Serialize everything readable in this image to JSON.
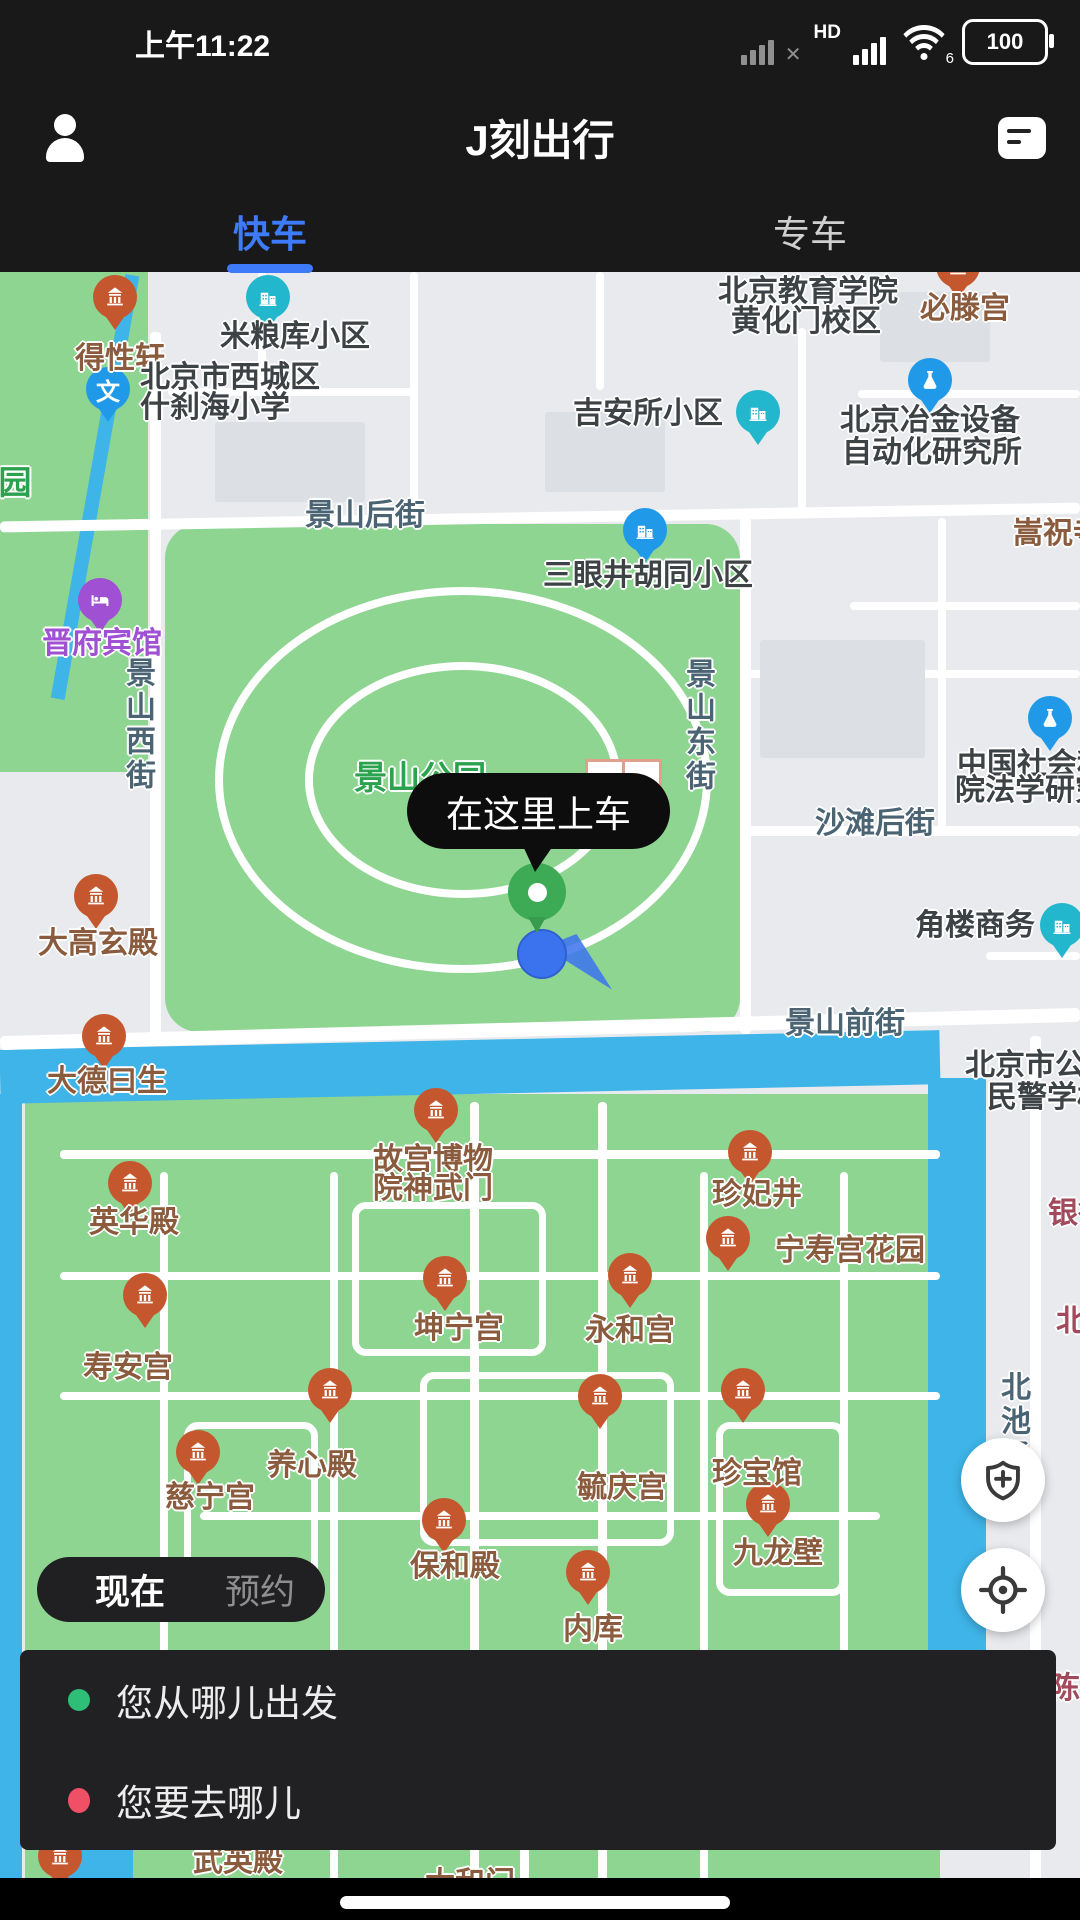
{
  "status_bar": {
    "time": "上午11:22",
    "hd_label": "HD",
    "wifi_label": "6",
    "battery_percent": "100"
  },
  "header": {
    "title": "J刻出行"
  },
  "tabs": [
    {
      "label": "快车",
      "active": true
    },
    {
      "label": "专车",
      "active": false
    }
  ],
  "colors": {
    "accent_blue": "#3e7bfa",
    "park_green": "#8fd592",
    "water_blue": "#3fb4e8",
    "temple_pin": "#c5572f",
    "teal_pin": "#23b7cd",
    "blue_pin": "#209ae8",
    "hotel_pin": "#a050d2",
    "pickup_green": "#3dab55",
    "location_blue": "#3b72ee",
    "from_dot": "#2fbe78",
    "to_dot": "#ef5066"
  },
  "map": {
    "pickup_bubble": "在这里上车",
    "labels": [
      {
        "t": "景山后街",
        "x": 365,
        "y": 240,
        "k": "street"
      },
      {
        "t": "景山西街",
        "x": 137,
        "y": 453,
        "k": "street",
        "v": 1
      },
      {
        "t": "景山东街",
        "x": 697,
        "y": 454,
        "k": "street",
        "v": 1
      },
      {
        "t": "沙滩后街",
        "x": 875,
        "y": 548,
        "k": "street"
      },
      {
        "t": "景山前街",
        "x": 845,
        "y": 748,
        "k": "street"
      },
      {
        "t": "北池子",
        "x": 1012,
        "y": 1150,
        "k": "street",
        "v": 1
      },
      {
        "t": "园",
        "x": 15,
        "y": 208,
        "k": "green"
      },
      {
        "t": "景山公园",
        "x": 420,
        "y": 503,
        "k": "green"
      },
      {
        "t": "银行",
        "x": 1048,
        "y": 938,
        "k": "maroon",
        "a": "l"
      },
      {
        "t": "北新",
        "x": 1056,
        "y": 1046,
        "k": "maroon",
        "a": "l"
      },
      {
        "t": "陈列",
        "x": 1050,
        "y": 1413,
        "k": "maroon",
        "a": "l"
      },
      {
        "t": "得性轩",
        "x": 120,
        "y": 83,
        "k": "brown"
      },
      {
        "t": "必滕宫",
        "x": 965,
        "y": 33,
        "k": "brown"
      },
      {
        "t": "嵩祝寺",
        "x": 1013,
        "y": 258,
        "k": "brown",
        "a": "l"
      },
      {
        "t": "晋府宾馆",
        "x": 102,
        "y": 368,
        "k": "purple"
      },
      {
        "t": "大高玄殿",
        "x": 98,
        "y": 668,
        "k": "brown"
      },
      {
        "t": "大德曰生",
        "x": 107,
        "y": 806,
        "k": "brown"
      },
      {
        "t": "故宫博物",
        "x": 433,
        "y": 884,
        "k": "brown"
      },
      {
        "t": "院神武门",
        "x": 433,
        "y": 913,
        "k": "brown"
      },
      {
        "t": "珍妃井",
        "x": 757,
        "y": 919,
        "k": "brown"
      },
      {
        "t": "宁寿宫花园",
        "x": 850,
        "y": 975,
        "k": "brown"
      },
      {
        "t": "英华殿",
        "x": 134,
        "y": 947,
        "k": "brown"
      },
      {
        "t": "寿安宫",
        "x": 128,
        "y": 1092,
        "k": "brown"
      },
      {
        "t": "坤宁宫",
        "x": 459,
        "y": 1053,
        "k": "brown"
      },
      {
        "t": "永和宫",
        "x": 630,
        "y": 1055,
        "k": "brown"
      },
      {
        "t": "养心殿",
        "x": 312,
        "y": 1190,
        "k": "brown"
      },
      {
        "t": "毓庆宫",
        "x": 622,
        "y": 1212,
        "k": "brown"
      },
      {
        "t": "珍宝馆",
        "x": 757,
        "y": 1198,
        "k": "brown"
      },
      {
        "t": "慈宁宫",
        "x": 210,
        "y": 1222,
        "k": "brown"
      },
      {
        "t": "保和殿",
        "x": 455,
        "y": 1291,
        "k": "brown"
      },
      {
        "t": "九龙壁",
        "x": 778,
        "y": 1278,
        "k": "brown"
      },
      {
        "t": "内库",
        "x": 593,
        "y": 1354,
        "k": "brown"
      },
      {
        "t": "武英殿",
        "x": 238,
        "y": 1586,
        "k": "brown"
      },
      {
        "t": "太和门",
        "x": 470,
        "y": 1608,
        "k": "brown"
      },
      {
        "t": "米粮库小区",
        "x": 295,
        "y": 61,
        "k": "dark"
      },
      {
        "t": "北京市西城区",
        "x": 140,
        "y": 102,
        "k": "dark",
        "a": "l"
      },
      {
        "t": "什刹海小学",
        "x": 140,
        "y": 132,
        "k": "dark",
        "a": "l"
      },
      {
        "t": "北京教育学院",
        "x": 808,
        "y": 16,
        "k": "dark"
      },
      {
        "t": "黄化门校区",
        "x": 806,
        "y": 46,
        "k": "dark"
      },
      {
        "t": "吉安所小区",
        "x": 648,
        "y": 138,
        "k": "dark"
      },
      {
        "t": "北京冶金设备",
        "x": 930,
        "y": 145,
        "k": "dark"
      },
      {
        "t": "自动化研究所",
        "x": 932,
        "y": 177,
        "k": "dark"
      },
      {
        "t": "三眼井胡同小区",
        "x": 648,
        "y": 300,
        "k": "dark"
      },
      {
        "t": "中国社会科",
        "x": 957,
        "y": 489,
        "k": "dark",
        "a": "l"
      },
      {
        "t": "院法学研究",
        "x": 955,
        "y": 515,
        "k": "dark",
        "a": "l"
      },
      {
        "t": "角楼商务",
        "x": 975,
        "y": 650,
        "k": "dark"
      },
      {
        "t": "北京市公安",
        "x": 965,
        "y": 790,
        "k": "dark",
        "a": "l"
      },
      {
        "t": "民警学校",
        "x": 987,
        "y": 822,
        "k": "dark",
        "a": "l"
      }
    ],
    "pins": [
      {
        "k": "temple",
        "x": 115,
        "y": 25
      },
      {
        "k": "temple",
        "x": 958,
        "y": -6
      },
      {
        "k": "building-teal",
        "x": 268,
        "y": 25
      },
      {
        "k": "school",
        "x": 108,
        "y": 117
      },
      {
        "k": "building-teal",
        "x": 758,
        "y": 140
      },
      {
        "k": "flask",
        "x": 930,
        "y": 108
      },
      {
        "k": "building-blue",
        "x": 645,
        "y": 258
      },
      {
        "k": "hotel",
        "x": 100,
        "y": 328
      },
      {
        "k": "flask",
        "x": 1050,
        "y": 446
      },
      {
        "k": "temple",
        "x": 96,
        "y": 624
      },
      {
        "k": "building-teal",
        "x": 1062,
        "y": 653
      },
      {
        "k": "temple",
        "x": 104,
        "y": 764
      },
      {
        "k": "temple",
        "x": 436,
        "y": 838
      },
      {
        "k": "temple",
        "x": 750,
        "y": 880
      },
      {
        "k": "temple",
        "x": 728,
        "y": 966
      },
      {
        "k": "temple",
        "x": 130,
        "y": 911
      },
      {
        "k": "temple",
        "x": 145,
        "y": 1023
      },
      {
        "k": "temple",
        "x": 445,
        "y": 1006
      },
      {
        "k": "temple",
        "x": 630,
        "y": 1003
      },
      {
        "k": "temple",
        "x": 330,
        "y": 1118
      },
      {
        "k": "temple",
        "x": 600,
        "y": 1124
      },
      {
        "k": "temple",
        "x": 743,
        "y": 1118
      },
      {
        "k": "temple",
        "x": 198,
        "y": 1180
      },
      {
        "k": "temple",
        "x": 444,
        "y": 1248
      },
      {
        "k": "temple",
        "x": 768,
        "y": 1232
      },
      {
        "k": "temple",
        "x": 588,
        "y": 1300
      },
      {
        "k": "temple",
        "x": 60,
        "y": 1584
      }
    ]
  },
  "time_pill": {
    "now": "现在",
    "reserve": "预约"
  },
  "sheet": {
    "from_placeholder": "您从哪儿出发",
    "to_placeholder": "您要去哪儿"
  }
}
